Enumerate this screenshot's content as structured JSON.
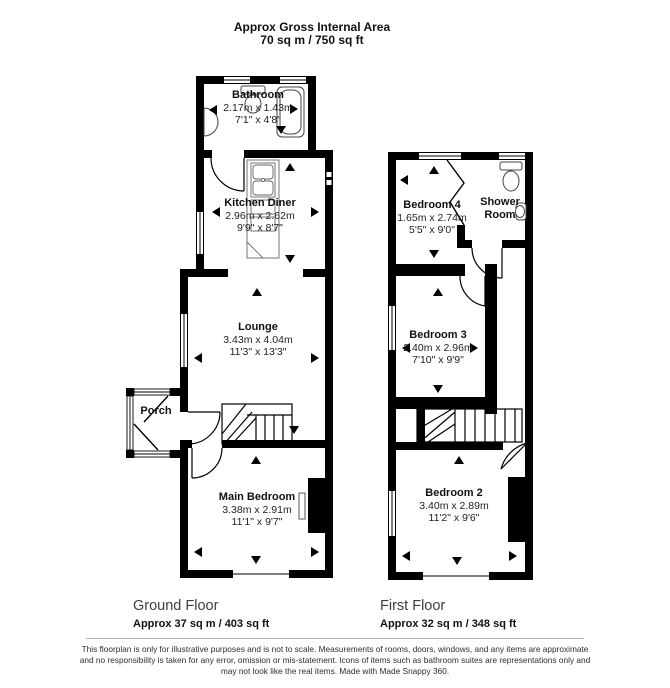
{
  "header": {
    "title": "Approx Gross Internal Area",
    "subtitle": "70 sq m / 750 sq ft"
  },
  "rooms": {
    "bathroom": {
      "name": "Bathroom",
      "metric": "2.17m x 1.43m",
      "imperial": "7'1\" x 4'8\""
    },
    "kitchen_diner": {
      "name": "Kitchen Diner",
      "metric": "2.96m x 2.62m",
      "imperial": "9'9\" x 8'7\""
    },
    "lounge": {
      "name": "Lounge",
      "metric": "3.43m x 4.04m",
      "imperial": "11'3\" x 13'3\""
    },
    "porch": {
      "name": "Porch"
    },
    "main_bedroom": {
      "name": "Main Bedroom",
      "metric": "3.38m x 2.91m",
      "imperial": "11'1\" x 9'7\""
    },
    "bedroom_4": {
      "name": "Bedroom 4",
      "metric": "1.65m x 2.74m",
      "imperial": "5'5\" x 9'0\""
    },
    "shower_room": {
      "name": "Shower Room"
    },
    "bedroom_3": {
      "name": "Bedroom 3",
      "metric": "2.40m x 2.96m",
      "imperial": "7'10\" x 9'9\""
    },
    "bedroom_2": {
      "name": "Bedroom 2",
      "metric": "3.40m x 2.89m",
      "imperial": "11'2\" x 9'6\""
    }
  },
  "floors": {
    "ground": {
      "label": "Ground Floor",
      "area": "Approx 37 sq m / 403 sq ft"
    },
    "first": {
      "label": "First Floor",
      "area": "Approx 32 sq m / 348 sq ft"
    }
  },
  "footer": {
    "line1": "This floorplan is only for illustrative purposes and is not to scale. Measurements of rooms, doors, windows, and any items are approximate",
    "line2": "and no responsibility is taken for any error, omission or mis-statement. Icons of items such as bathroom suites are representations only and",
    "line3": "may not look like the real items. Made with Made Snappy 360."
  },
  "colors": {
    "wall": "#000000",
    "background": "#ffffff",
    "text": "#1a1a1a",
    "muted": "#3d3d3d"
  }
}
